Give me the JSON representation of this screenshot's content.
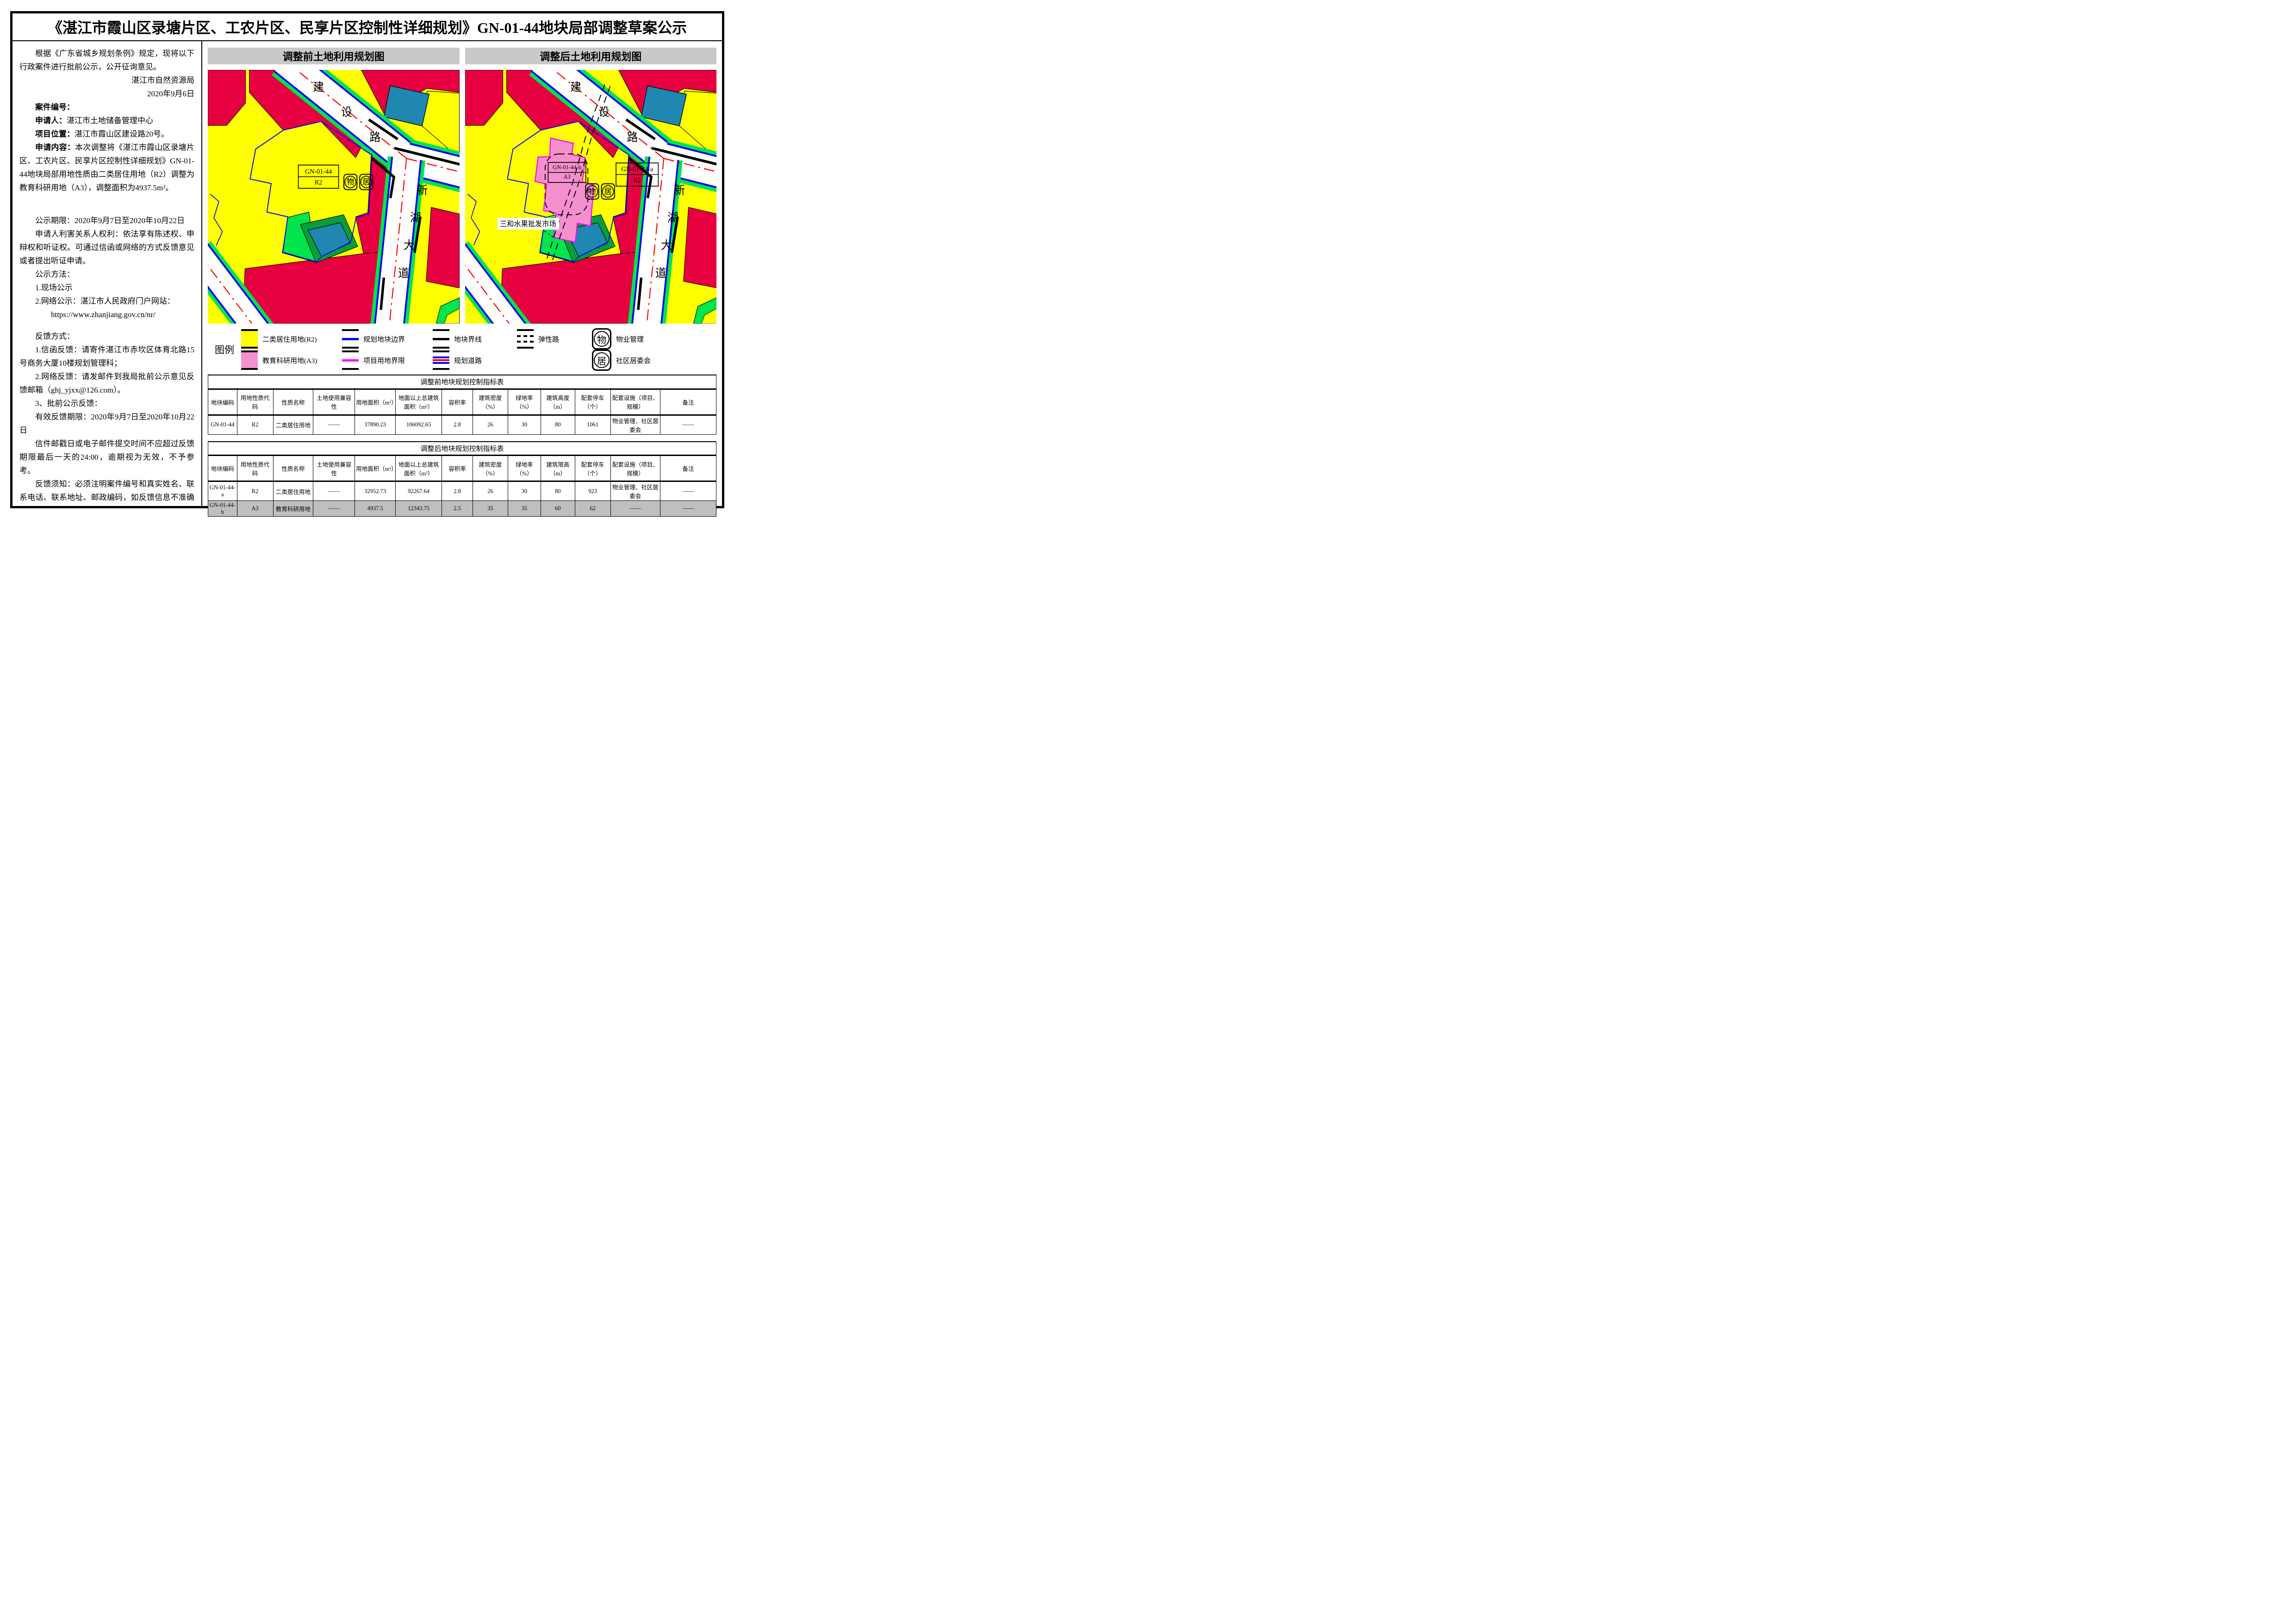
{
  "title": "《湛江市霞山区录塘片区、工农片区、民享片区控制性详细规划》GN-01-44地块局部调整草案公示",
  "notice": {
    "paragraphs": [
      {
        "indent": true,
        "segments": [
          {
            "t": "根据《广东省城乡规划条例》规定，现将以下行政案件进行批前公示，公开征询意见。"
          }
        ]
      },
      {
        "align": "right",
        "segments": [
          {
            "t": "湛江市自然资源局"
          }
        ]
      },
      {
        "align": "right",
        "segments": [
          {
            "t": "2020年9月6日"
          }
        ]
      },
      {
        "indent": true,
        "segments": [
          {
            "t": "案件编号：",
            "b": true
          }
        ]
      },
      {
        "indent": true,
        "segments": [
          {
            "t": "申请人：",
            "b": true
          },
          {
            "t": "湛江市土地储备管理中心"
          }
        ]
      },
      {
        "indent": true,
        "segments": [
          {
            "t": "项目位置：",
            "b": true
          },
          {
            "t": "湛江市霞山区建设路20号。"
          }
        ]
      },
      {
        "indent": true,
        "segments": [
          {
            "t": "申请内容：",
            "b": true
          },
          {
            "t": "本次调整将《湛江市霞山区录塘片区、工农片区、民享片区控制性详细规划》GN-01-44地块局部用地性质由二类居住用地（R2）调整为教育科研用地（A3），调整面积为4937.5m²。"
          }
        ]
      },
      {
        "indent": true,
        "gap": true,
        "segments": [
          {
            "t": "公示期限：2020年9月7日至2020年10月22日"
          }
        ]
      },
      {
        "indent": true,
        "segments": [
          {
            "t": "申请人利害关系人权利：依法享有陈述权、申辩权和听证权。可通过信函或网络的方式反馈意见或者提出听证申请。"
          }
        ]
      },
      {
        "indent": true,
        "segments": [
          {
            "t": "公示方法："
          }
        ]
      },
      {
        "indent": true,
        "segments": [
          {
            "t": "1.现场公示"
          }
        ]
      },
      {
        "indent": true,
        "segments": [
          {
            "t": "2.网络公示：湛江市人民政府门户网站："
          }
        ]
      },
      {
        "indent2": true,
        "segments": [
          {
            "t": "https://www.zhanjiang.gov.cn/nr/"
          }
        ]
      },
      {
        "indent": true,
        "gap2": true,
        "segments": [
          {
            "t": "反馈方式："
          }
        ]
      },
      {
        "indent": true,
        "segments": [
          {
            "t": "1.信函反馈：请寄件湛江市赤坎区体育北路15号商务大厦10楼规划管理科；"
          }
        ]
      },
      {
        "indent": true,
        "segments": [
          {
            "t": "2.网络反馈：请发邮件到我局批前公示意见反馈邮箱（ghj_yjxx@126.com）。"
          }
        ]
      },
      {
        "indent": true,
        "segments": [
          {
            "t": "3、批前公示反馈："
          }
        ]
      },
      {
        "indent": true,
        "segments": [
          {
            "t": "有效反馈期限：2020年9月7日至2020年10月22日"
          }
        ]
      },
      {
        "indent": true,
        "segments": [
          {
            "t": "信件邮戳日或电子邮件提交时间不应超过反馈期限最后一天的24:00，逾期视为无效，不予参考。"
          }
        ]
      },
      {
        "indent": true,
        "segments": [
          {
            "t": "反馈须知：必须注明案件编号和真实姓名、联系电话、联系地址、邮政编码，如反馈信息不准确或不完整，导致无法核实有关情况的视为无效。"
          }
        ]
      }
    ]
  },
  "maps": {
    "before": {
      "header": "调整前土地利用规划图",
      "parcel_label_line1": "GN-01-44",
      "parcel_label_line2": "R2"
    },
    "after": {
      "header": "调整后土地利用规划图",
      "label_b_line1": "GN-01-44-b",
      "label_b_line2": "A3",
      "label_a_line1": "GN-01-44-a",
      "label_a_line2": "R2",
      "market_label": "三和水果批发市场"
    },
    "road_labels": {
      "jianshelu": [
        "建",
        "设",
        "路"
      ],
      "xinhudadao": [
        "新",
        "湖",
        "大",
        "道"
      ]
    },
    "icons": {
      "property": "物",
      "community": "居"
    }
  },
  "legend": {
    "title": "图例",
    "row1": [
      {
        "type": "fill",
        "color": "#FFFF00",
        "label": "二类居住用地(R2)"
      },
      {
        "type": "line",
        "color": "#0000FF",
        "label": "规划地块边界"
      },
      {
        "type": "line",
        "color": "#000000",
        "label": "地块界线"
      },
      {
        "type": "dash",
        "label": "弹性路"
      },
      {
        "type": "icon",
        "char": "物",
        "label": "物业管理"
      }
    ],
    "row2": [
      {
        "type": "fill",
        "color": "#F590CE",
        "label": "教育科研用地(A3)"
      },
      {
        "type": "line",
        "color": "#FF00FF",
        "label": "项目用地界限"
      },
      {
        "type": "road",
        "label": "规划道路"
      },
      {
        "type": "icon",
        "char": "居",
        "label": "社区居委会"
      }
    ]
  },
  "tables": [
    {
      "title": "调整前地块规划控制指标表",
      "headers": [
        "地块编码",
        "用地性质代码",
        "性质名称",
        "土地使用兼容性",
        "用地面积（m²）",
        "地面以上总建筑面积（m²）",
        "容积率",
        "建筑密度（%）",
        "绿地率（%）",
        "建筑高度（m）",
        "配套停车（个）",
        "配套设施（项目、规模）",
        "备注"
      ],
      "rows": [
        {
          "shaded": false,
          "cells": [
            "GN-01-44",
            "R2",
            "二类居住用地",
            "——",
            "37890.23",
            "106092.65",
            "2.8",
            "26",
            "30",
            "80",
            "1061",
            "物业管理、社区居委会",
            "——"
          ]
        }
      ]
    },
    {
      "title": "调整后地块规划控制指标表",
      "headers": [
        "地块编码",
        "用地性质代码",
        "性质名称",
        "土地使用兼容性",
        "用地面积（m²）",
        "地面以上总建筑面积（m²）",
        "容积率",
        "建筑密度（%）",
        "绿地率（%）",
        "建筑限高（m）",
        "配套停车（个）",
        "配套设施（项目、规模）",
        "备注"
      ],
      "rows": [
        {
          "shaded": false,
          "cells": [
            "GN-01-44-a",
            "R2",
            "二类居住用地",
            "——",
            "32952.73",
            "92267.64",
            "2.8",
            "26",
            "30",
            "80",
            "923",
            "物业管理、社区居委会",
            "——"
          ]
        },
        {
          "shaded": true,
          "cells": [
            "GN-01-44-b",
            "A3",
            "教育科研用地",
            "——",
            "4937.5",
            "12343.75",
            "2.5",
            "35",
            "35",
            "60",
            "62",
            "——",
            "——"
          ]
        }
      ]
    }
  ],
  "colors": {
    "yellow": "#FFFF00",
    "pink": "#F590CE",
    "red": "#E60040",
    "green": "#00E54C",
    "dark_green": "#089E38",
    "teal": "#1F87B0",
    "blue": "#0000FF",
    "magenta": "#FF00FF",
    "centerline": "#FF0000",
    "header_grey": "#C9C9C9",
    "row_grey": "#BFBFBF"
  }
}
